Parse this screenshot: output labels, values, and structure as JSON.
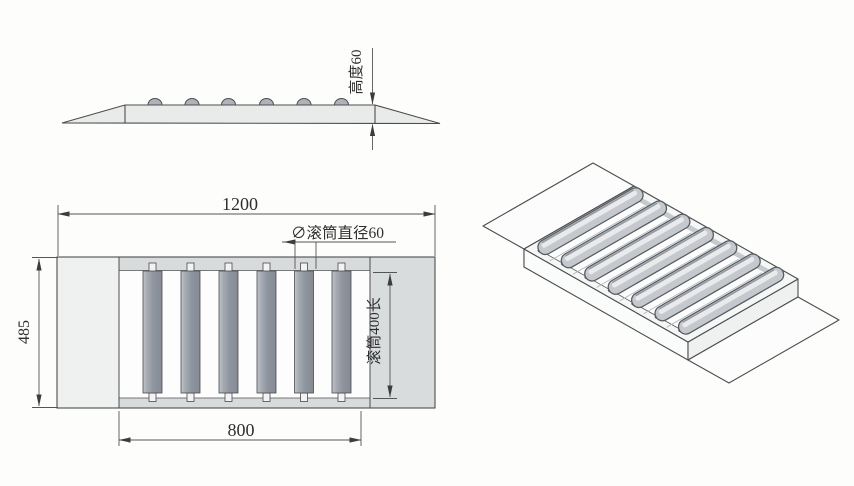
{
  "drawing": {
    "side_view": {
      "height_dim_label": "高度60"
    },
    "plan_view": {
      "total_length_dim": "1200",
      "overall_width_dim": "485",
      "roller_span_dim": "800",
      "roller_diameter_label": "∅滚筒直径60",
      "roller_length_label": "滚筒400长"
    },
    "palette": {
      "line": "#4d4d4d",
      "dimension_line": "#555555",
      "slab_fill": "#e9ebea",
      "band_fill": "#d8dbdb",
      "roller_fill": "#8f959e",
      "flap_left_fill": "#eff1f0",
      "flap_right_fill": "#d9dcdc",
      "background": "#fdfdfc"
    }
  }
}
